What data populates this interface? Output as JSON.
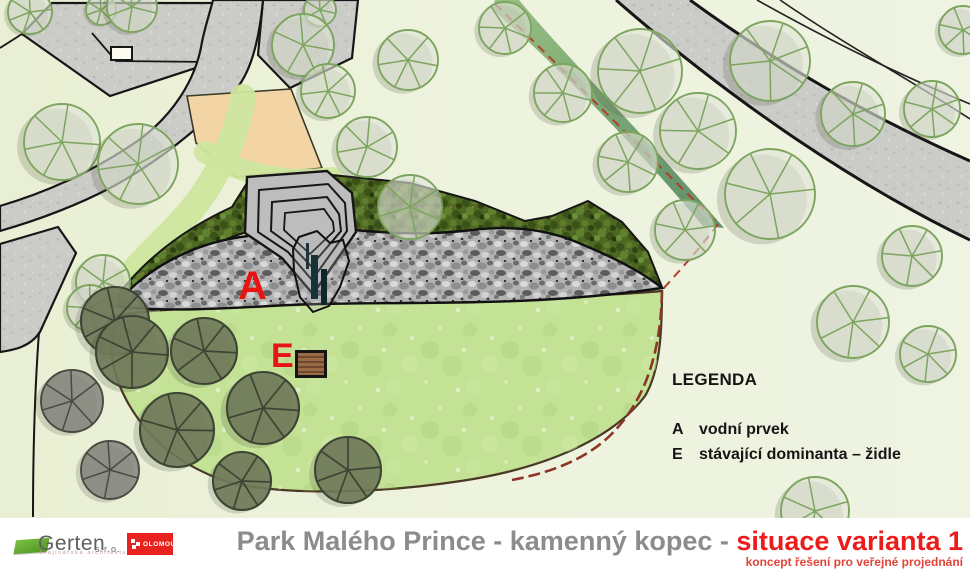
{
  "map": {
    "labels": {
      "a": "A",
      "e": "E"
    },
    "colors": {
      "background": "#edf2dc",
      "lawn_green": "#c3e295",
      "road_gray": "#cbcbc7",
      "stone_gray": "#b3b3b3",
      "vegetation_green": "#4d6823",
      "tan_path": "#f3d4a5",
      "boundary_red": "#9b3a2a",
      "marker_red": "#e81414"
    },
    "trees": {
      "light": [
        [
          30,
          12,
          22
        ],
        [
          101,
          10,
          15
        ],
        [
          132,
          7,
          25
        ],
        [
          320,
          10,
          16
        ],
        [
          303,
          45,
          31
        ],
        [
          328,
          91,
          27
        ],
        [
          408,
          60,
          30
        ],
        [
          62,
          142,
          38
        ],
        [
          138,
          164,
          40
        ],
        [
          367,
          147,
          30
        ],
        [
          410,
          207,
          32
        ],
        [
          103,
          282,
          27
        ],
        [
          90,
          308,
          23
        ],
        [
          505,
          28,
          26
        ],
        [
          563,
          93,
          29
        ],
        [
          640,
          71,
          42
        ],
        [
          698,
          131,
          38
        ],
        [
          770,
          61,
          40
        ],
        [
          853,
          114,
          32
        ],
        [
          932,
          109,
          28
        ],
        [
          963,
          30,
          24
        ],
        [
          628,
          162,
          30
        ],
        [
          770,
          194,
          45
        ],
        [
          685,
          230,
          30
        ],
        [
          912,
          256,
          30
        ],
        [
          853,
          322,
          36
        ],
        [
          928,
          354,
          28
        ],
        [
          815,
          511,
          34
        ]
      ],
      "dark": [
        [
          115,
          321,
          34
        ],
        [
          132,
          352,
          36
        ],
        [
          204,
          351,
          33
        ],
        [
          177,
          430,
          37
        ],
        [
          263,
          408,
          36
        ],
        [
          242,
          481,
          29
        ],
        [
          348,
          470,
          33
        ]
      ],
      "gray": [
        [
          72,
          401,
          31
        ],
        [
          110,
          470,
          29
        ]
      ]
    }
  },
  "legend": {
    "title": "LEGENDA",
    "items": [
      {
        "key": "A",
        "label": "vodní prvek"
      },
      {
        "key": "E",
        "label": "stávající dominanta – židle"
      }
    ]
  },
  "footer": {
    "title_gray": "Park Malého Prince - kamenný kopec - ",
    "title_red": "situace varianta 1",
    "subtitle": "koncept řešení pro veřejné projednání",
    "logo": {
      "brand": "Gerten",
      "suffix": "s.r.o.",
      "tagline": "krajinářská architektura",
      "badge": "OLOMOUC"
    }
  }
}
